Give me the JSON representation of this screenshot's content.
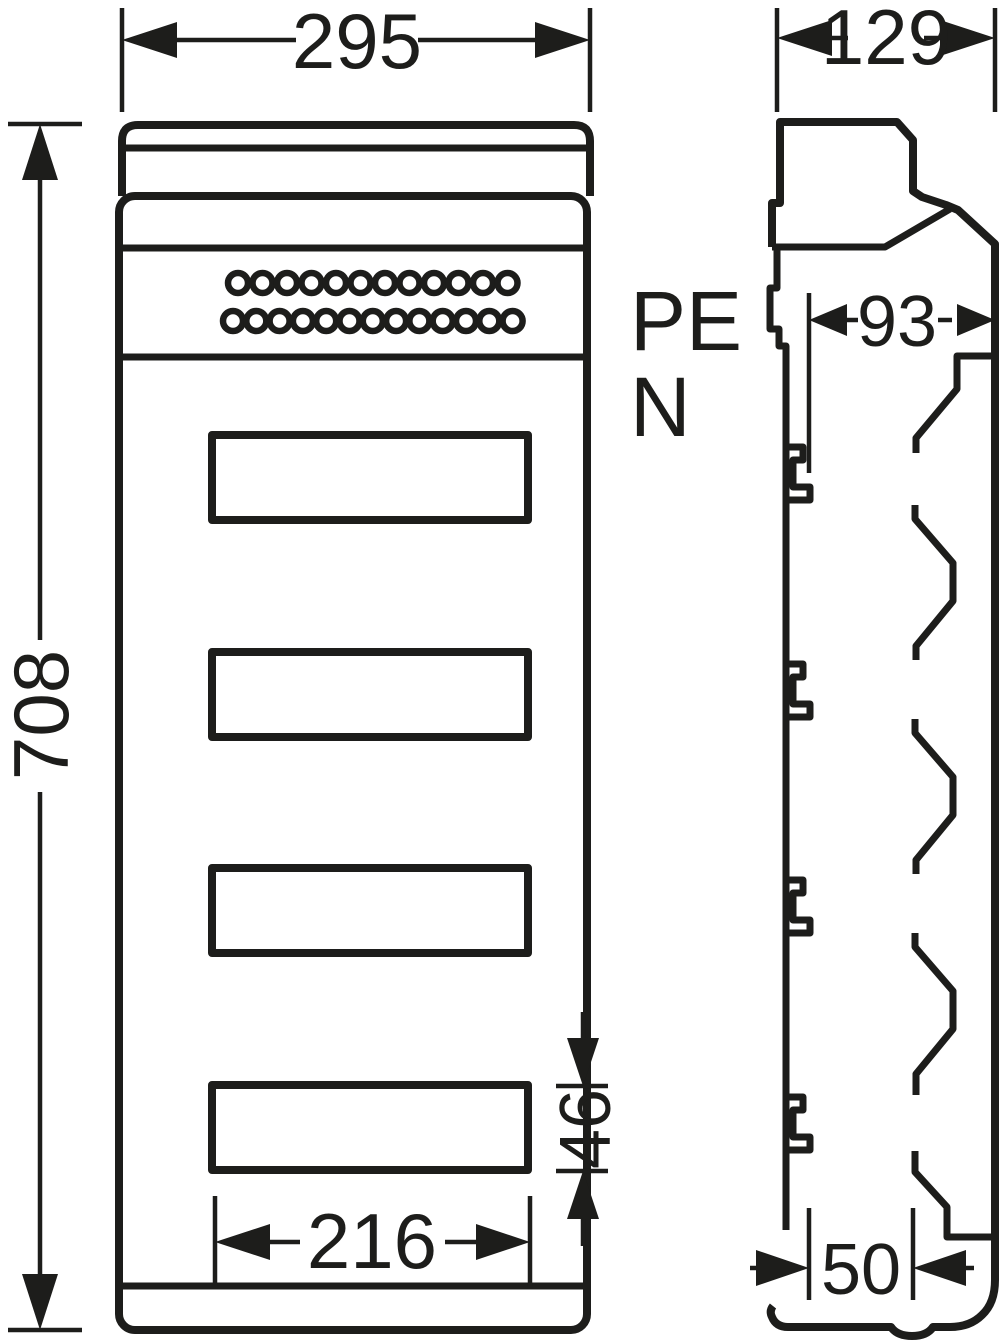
{
  "drawing": {
    "type": "technical-dimension-drawing",
    "subject": "distribution-enclosure front and side views",
    "line_color": "#1d1d1b",
    "background": "#ffffff",
    "labels": {
      "pe": "PE",
      "n": "N"
    },
    "dimensions": {
      "front_width": "295",
      "side_depth": "129",
      "front_height": "708",
      "device_depth": "93",
      "window_height": "46",
      "window_width": "216",
      "base_depth": "50"
    },
    "front_view": {
      "window_count": 4,
      "terminal_rows": [
        {
          "holes": 12
        },
        {
          "holes": 13
        }
      ]
    }
  }
}
